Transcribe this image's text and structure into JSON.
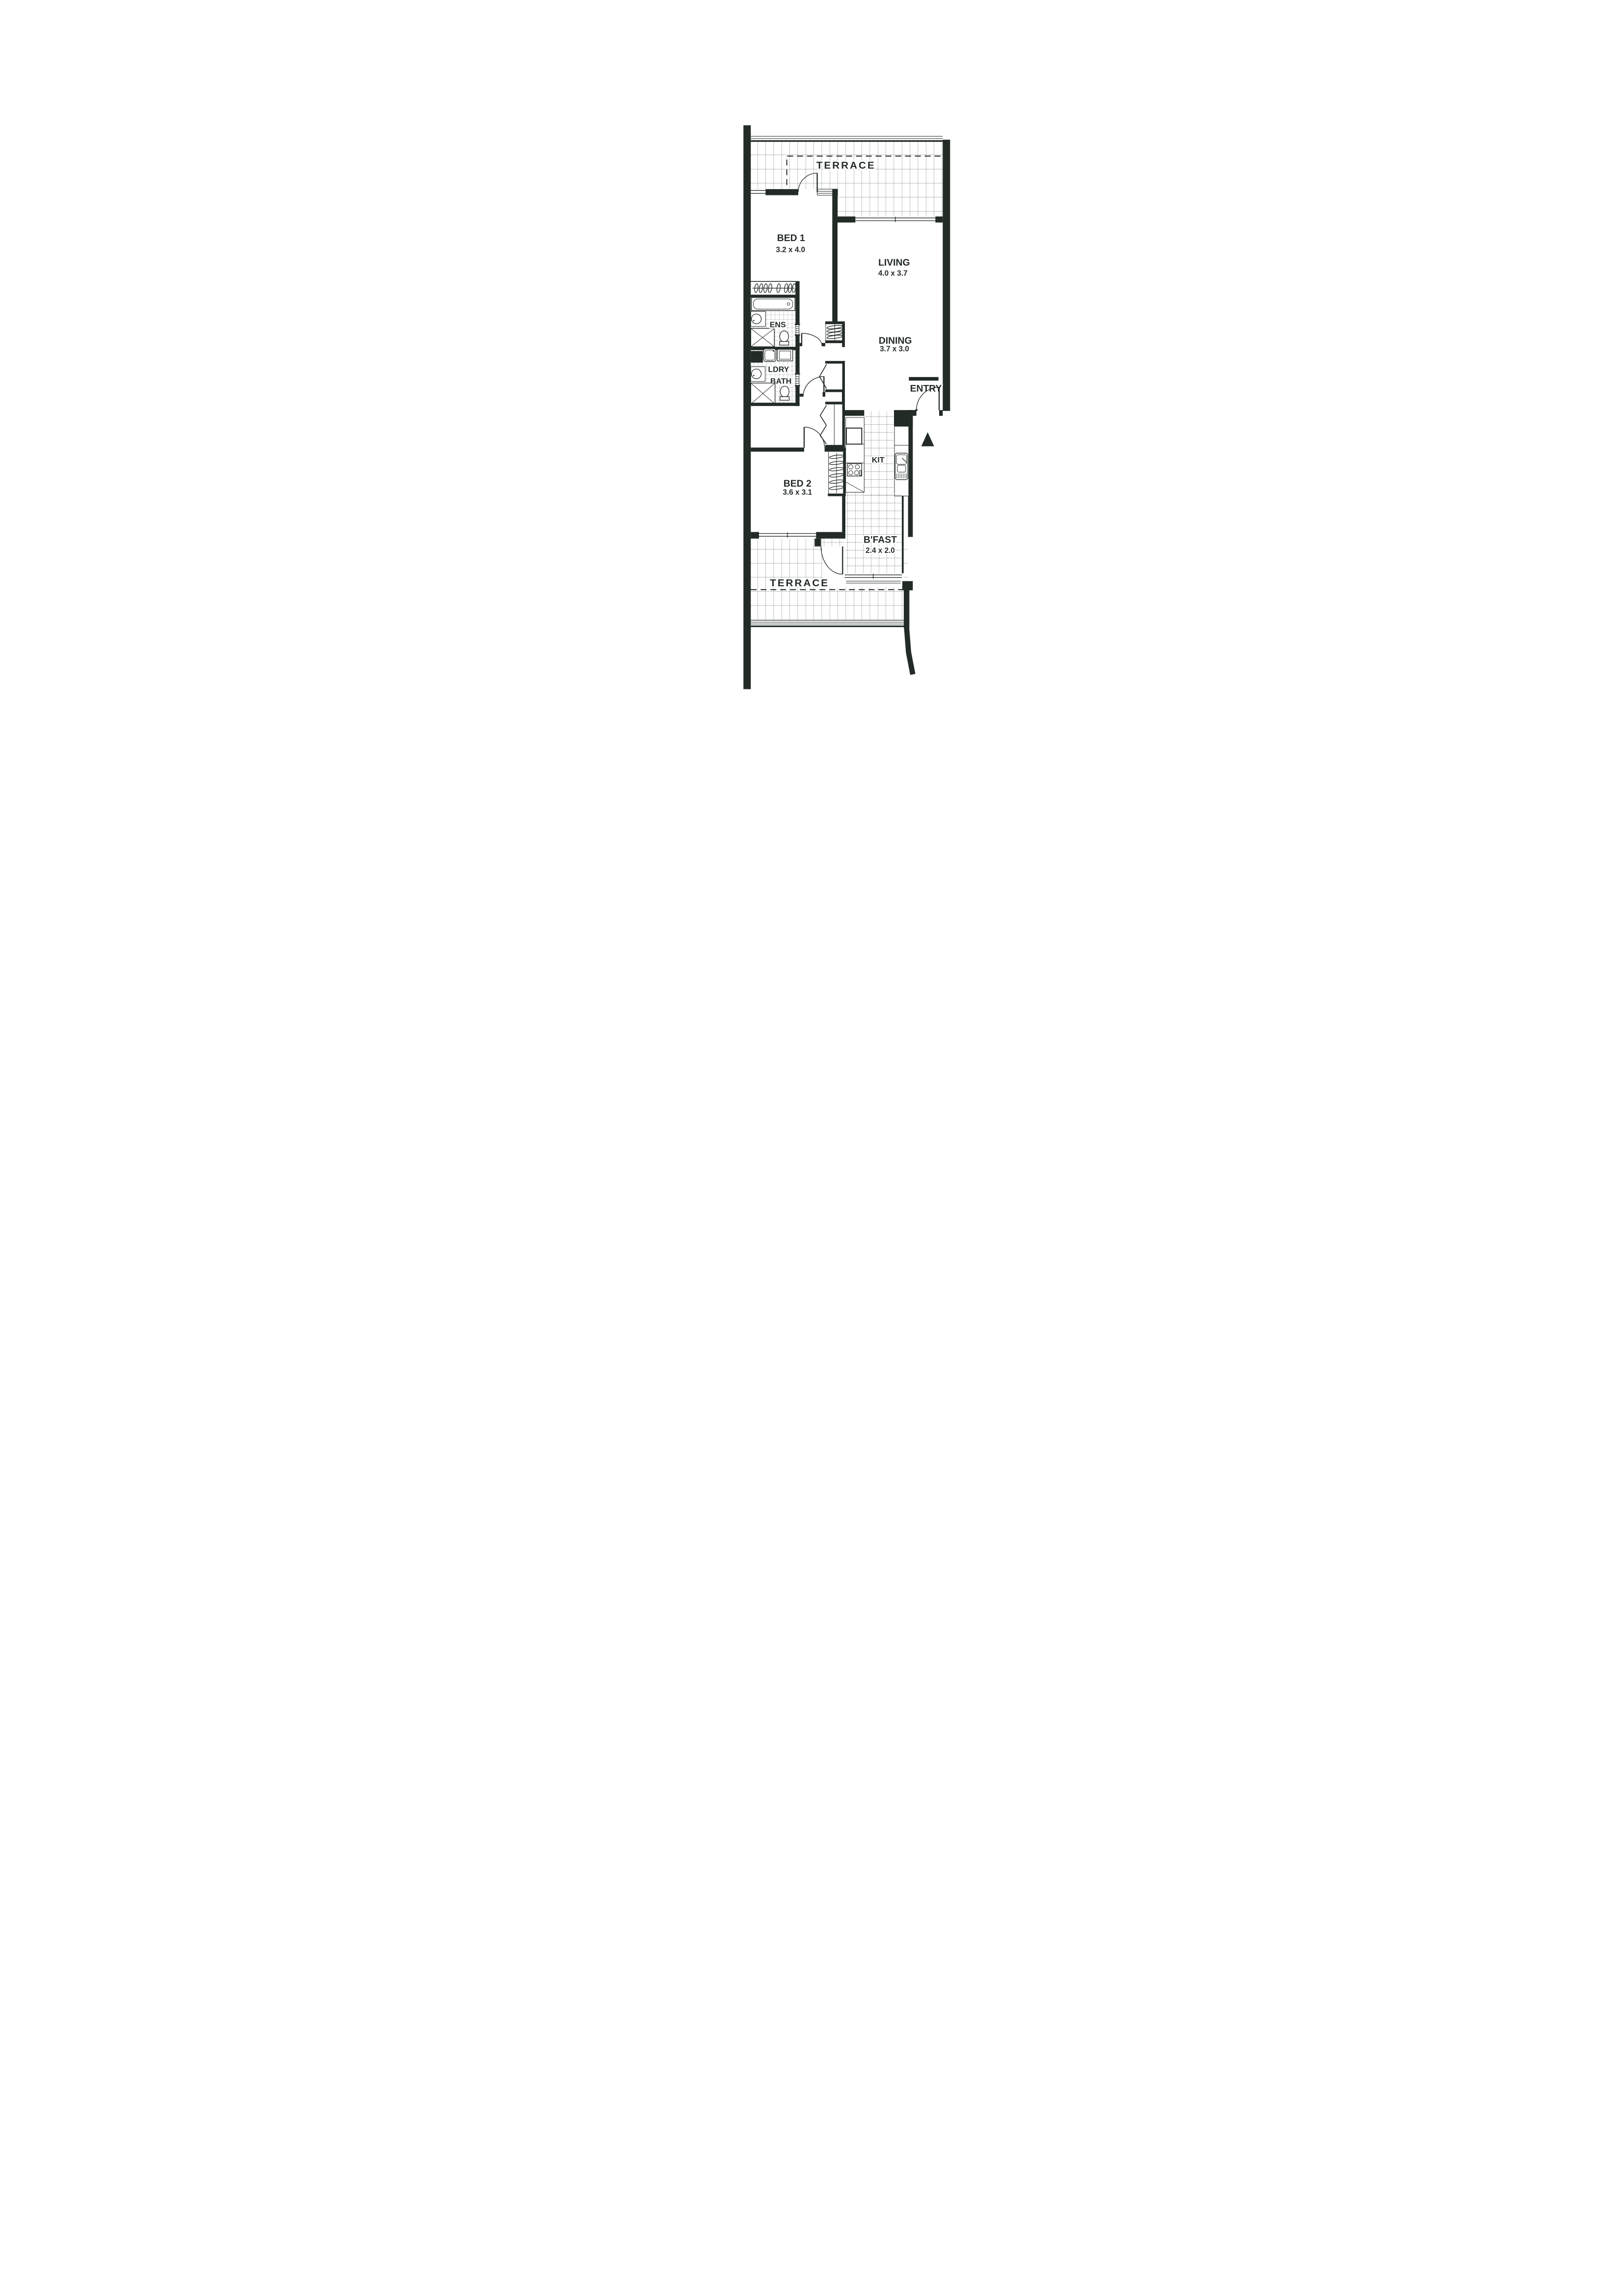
{
  "document": {
    "kind": "apartment floor plan",
    "paper_color": "#ffffff",
    "ink_color": "#232b26"
  },
  "rooms": {
    "terrace_top": {
      "name": "TERRACE"
    },
    "bed1": {
      "name": "BED 1",
      "dim": "3.2 x 4.0"
    },
    "living": {
      "name": "LIVING",
      "dim": "4.0 x 3.7"
    },
    "dining": {
      "name": "DINING",
      "dim": "3.7 x 3.0"
    },
    "ens": {
      "name": "ENS"
    },
    "ldry": {
      "name": "LDRY"
    },
    "bath": {
      "name": "BATH"
    },
    "entry": {
      "name": "ENTRY"
    },
    "bed2": {
      "name": "BED 2",
      "dim": "3.6 x 3.1"
    },
    "kit": {
      "name": "KIT"
    },
    "bfast": {
      "name": "B'FAST",
      "dim": "2.4 x 2.0"
    },
    "terrace_bottom": {
      "name": "TERRACE"
    }
  }
}
